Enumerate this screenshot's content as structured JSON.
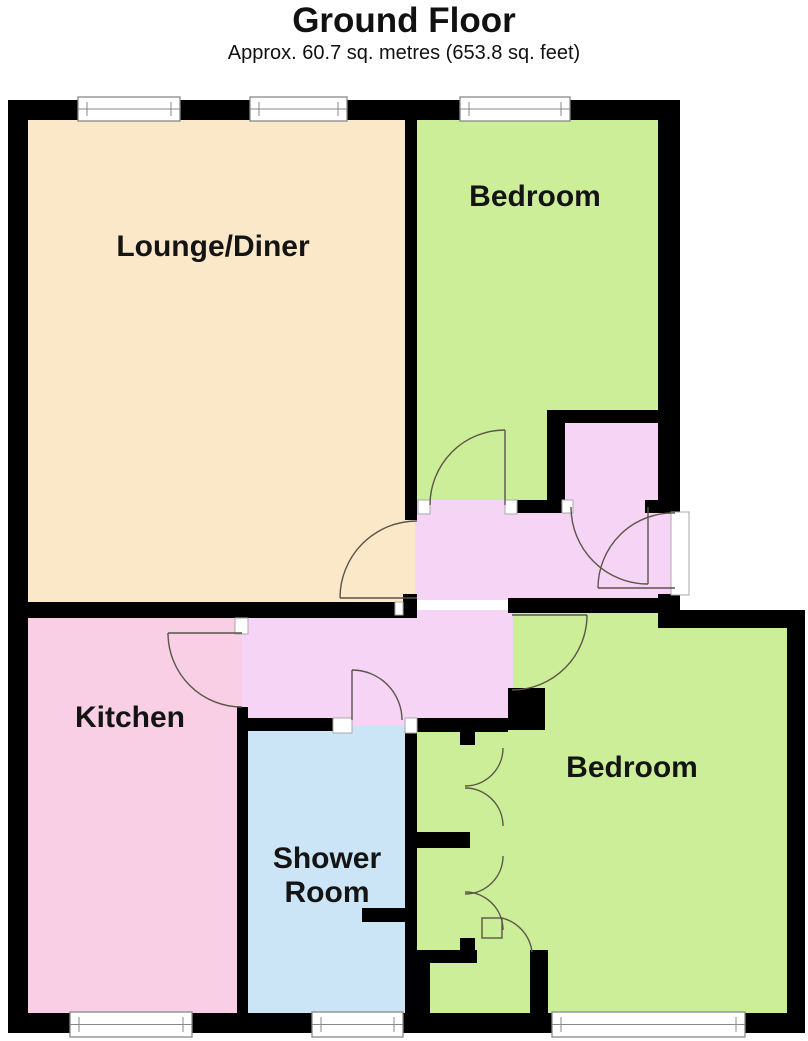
{
  "header": {
    "title": "Ground Floor",
    "subtitle": "Approx. 60.7 sq. metres (653.8 sq. feet)"
  },
  "rooms": {
    "lounge": {
      "label": "Lounge/Diner",
      "color": "#fae8c8"
    },
    "bedroom_top": {
      "label": "Bedroom",
      "color": "#cdee98"
    },
    "bedroom_bottom": {
      "label": "Bedroom",
      "color": "#cdee98"
    },
    "kitchen": {
      "label": "Kitchen",
      "color": "#f8cfe4"
    },
    "shower": {
      "label_line1": "Shower",
      "label_line2": "Room",
      "color": "#cbe4f6"
    },
    "hall": {
      "color": "#f5d4f5"
    }
  },
  "colors": {
    "wall": "#000000",
    "door_line": "#5b5548",
    "window_border": "#888888",
    "post_border": "#aaaaaa",
    "text": "#141414",
    "background": "#ffffff"
  }
}
